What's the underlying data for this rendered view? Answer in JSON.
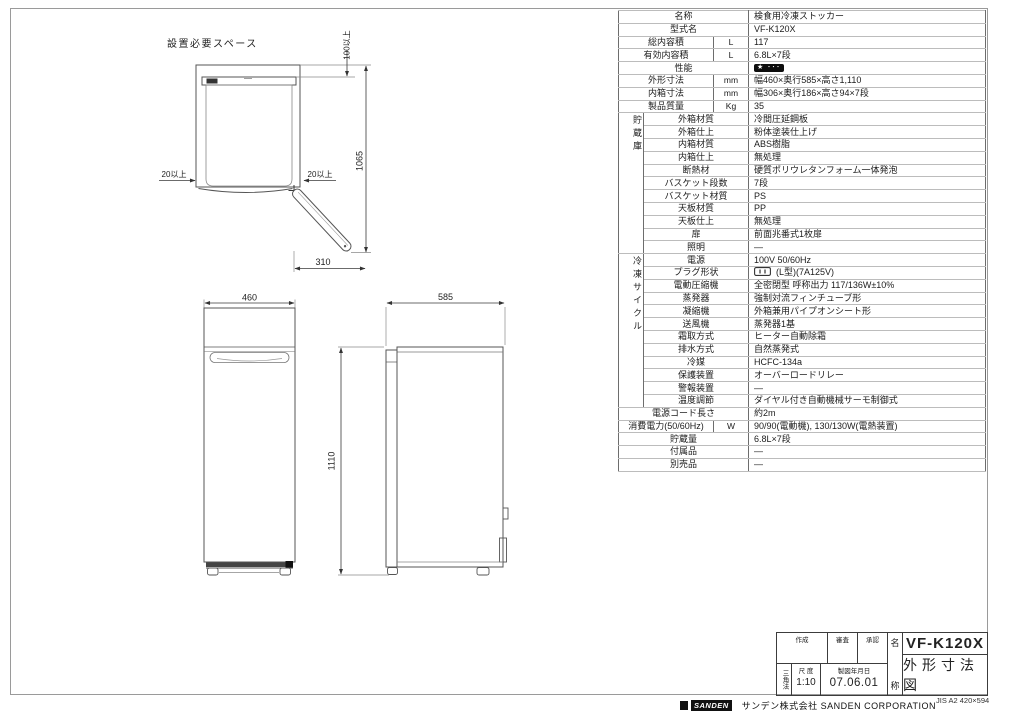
{
  "drawings": {
    "plan": {
      "label": "設置必要スペース",
      "clearance_top": "100以上",
      "overall_height": "1065",
      "clearance_left": "20以上",
      "clearance_right": "20以上",
      "door_swing": "310"
    },
    "front": {
      "width": "460",
      "height": "1110"
    },
    "side": {
      "depth": "585"
    }
  },
  "spec_table": {
    "rows": [
      {
        "name": "名称",
        "span": "wide",
        "value": "検食用冷凍ストッカー"
      },
      {
        "name": "型式名",
        "span": "wide",
        "value": "VF-K120X"
      },
      {
        "name": "総内容積",
        "unit": "L",
        "value": "117"
      },
      {
        "name": "有効内容積",
        "unit": "L",
        "value": "6.8L×7段"
      },
      {
        "name": "性能",
        "span": "wide",
        "value": "",
        "badge": "★ ･･･"
      },
      {
        "name": "外形寸法",
        "unit": "mm",
        "value": "幅460×奥行585×高さ1,110"
      },
      {
        "name": "内箱寸法",
        "unit": "mm",
        "value": "幅306×奥行186×高さ94×7段"
      },
      {
        "name": "製品質量",
        "unit": "Kg",
        "value": "35"
      },
      {
        "group": "貯蔵庫",
        "group_span": 11,
        "name": "外箱材質",
        "value": "冷間圧延鋼板"
      },
      {
        "name": "外箱仕上",
        "value": "粉体塗装仕上げ"
      },
      {
        "name": "内箱材質",
        "value": "ABS樹脂"
      },
      {
        "name": "内箱仕上",
        "value": "無処理"
      },
      {
        "name": "断熱材",
        "value": "硬質ポリウレタンフォーム一体発泡"
      },
      {
        "name": "バスケット段数",
        "value": "7段"
      },
      {
        "name": "バスケット材質",
        "value": "PS"
      },
      {
        "name": "天板材質",
        "value": "PP"
      },
      {
        "name": "天板仕上",
        "value": "無処理"
      },
      {
        "name": "扉",
        "value": "前面兆番式1枚扉"
      },
      {
        "name": "照明",
        "value": "—"
      },
      {
        "group": "冷凍サイクル",
        "group_span": 12,
        "name": "電源",
        "value": "100V  50/60Hz"
      },
      {
        "name": "プラグ形状",
        "icon": "plug",
        "value": "(L型)(7A125V)"
      },
      {
        "name": "電動圧縮機",
        "value": "全密閉型  呼称出力  117/136W±10%"
      },
      {
        "name": "蒸発器",
        "value": "強制対流フィンチューブ形"
      },
      {
        "name": "凝縮機",
        "value": "外箱兼用パイプオンシート形"
      },
      {
        "name": "送風機",
        "value": "蒸発器1基"
      },
      {
        "name": "霜取方式",
        "value": "ヒーター自動除霜"
      },
      {
        "name": "排水方式",
        "value": "自然蒸発式"
      },
      {
        "name": "冷媒",
        "value": "HCFC-134a"
      },
      {
        "name": "保護装置",
        "value": "オーバーロードリレー"
      },
      {
        "name": "警報装置",
        "value": "—"
      },
      {
        "name": "温度調節",
        "value": "ダイヤル付き自動機械サーモ制御式"
      },
      {
        "name": "電源コード長さ",
        "span": "wide",
        "value": "約2m"
      },
      {
        "name": "消費電力(50/60Hz)",
        "unit": "W",
        "value": "90/90(電動機), 130/130W(電熱装置)"
      },
      {
        "name": "貯蔵量",
        "span": "wide",
        "value": "6.8L×7段"
      },
      {
        "name": "付属品",
        "span": "wide",
        "value": "—"
      },
      {
        "name": "別売品",
        "span": "wide",
        "value": "—"
      }
    ]
  },
  "title_block": {
    "created_label": "作成",
    "review_label": "審査",
    "approved_label": "承認",
    "projection_label": "三角法",
    "scale_label": "尺 度",
    "scale_value": "1:10",
    "date_label": "製図年月日",
    "date_value": "07.06.01",
    "name_col_top": "名",
    "name_col_bottom": "称",
    "model": "VF-K120X",
    "drawing_title": "外形寸法図"
  },
  "footer": {
    "logo_text": "SANDEN",
    "company": "サンデン株式会社 SANDEN CORPORATION",
    "paper_note": "JIS A2 420×594"
  }
}
